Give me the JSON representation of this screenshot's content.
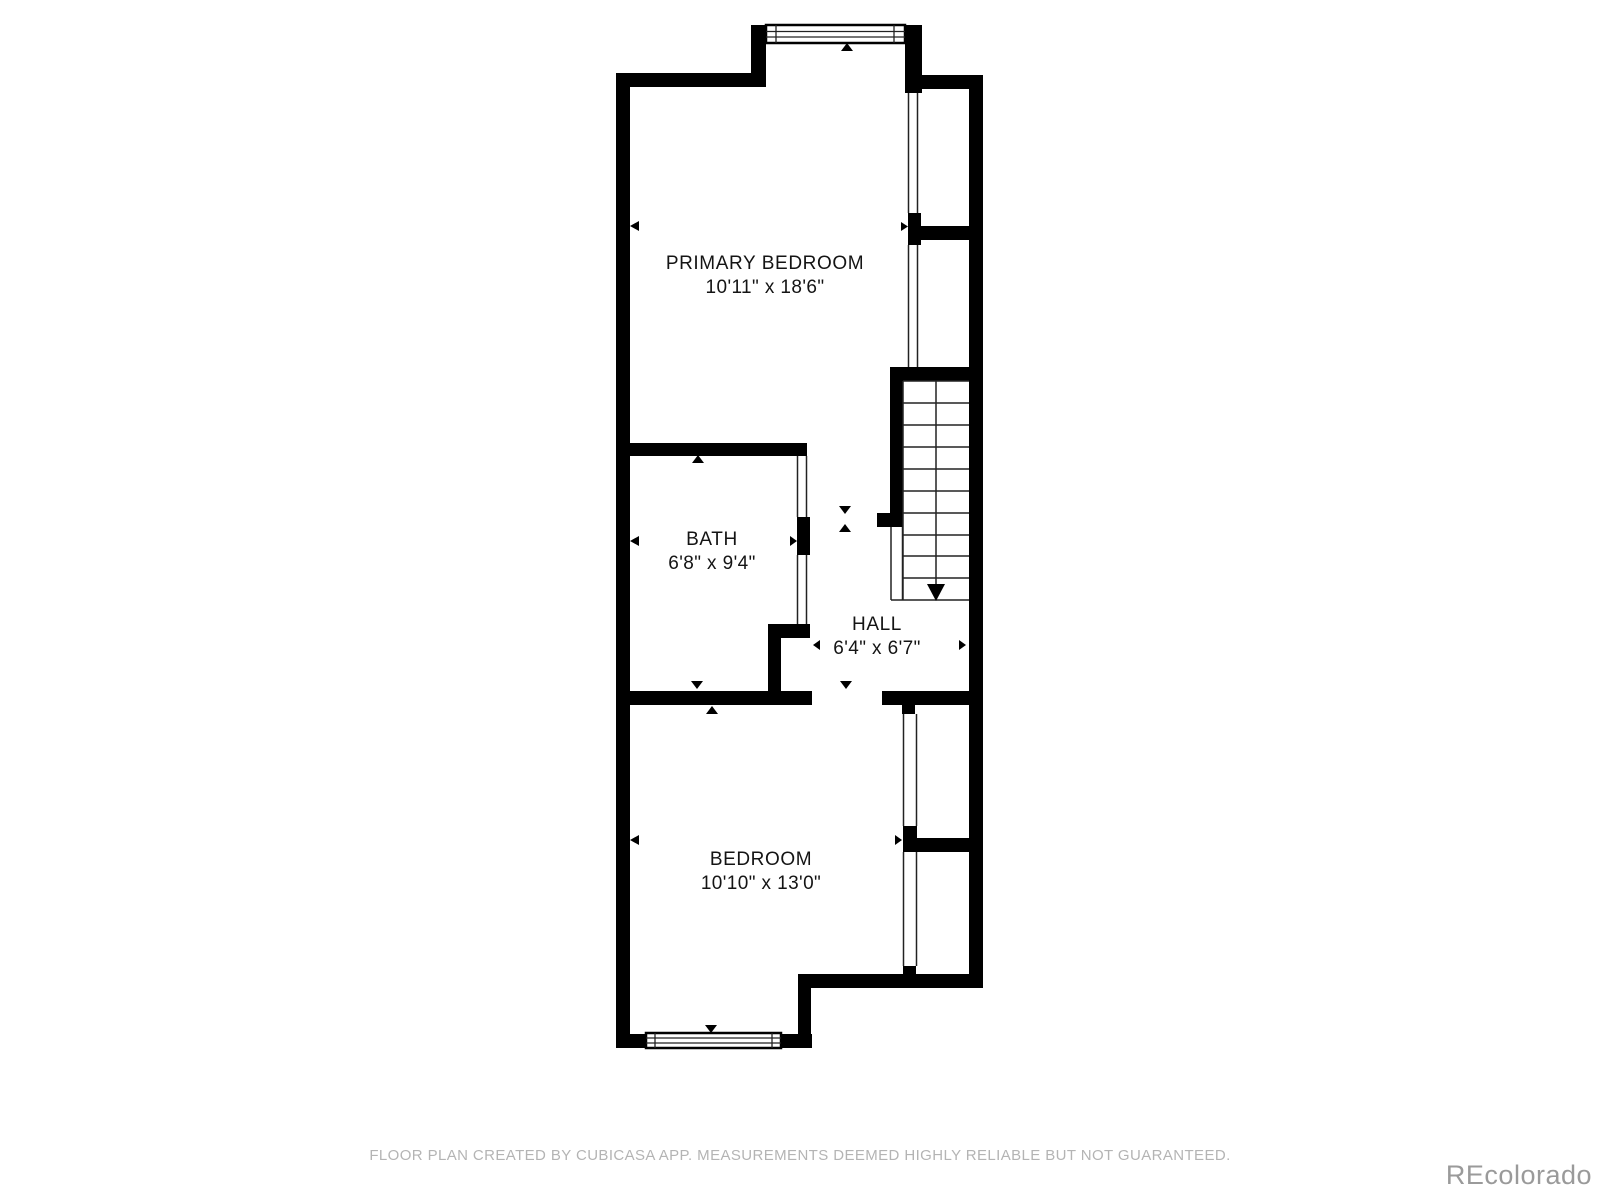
{
  "floor_plan": {
    "rooms": [
      {
        "name": "PRIMARY BEDROOM",
        "dimensions": "10'11\" x 18'6\""
      },
      {
        "name": "BATH",
        "dimensions": "6'8\" x 9'4\""
      },
      {
        "name": "HALL",
        "dimensions": "6'4\" x 6'7\""
      },
      {
        "name": "BEDROOM",
        "dimensions": "10'10\" x 13'0\""
      }
    ],
    "features": {
      "stairs": "staircase-with-down-arrow",
      "top_window": "double-line-window",
      "bottom_window": "double-line-window",
      "markers": "wall-measurement-triangles"
    },
    "colors": {
      "wall": "#000000",
      "room_text": "#141414",
      "disclaimer_text": "#b4b4b4",
      "watermark_text": "#9a9a9a",
      "background": "#ffffff"
    }
  },
  "footer": {
    "disclaimer": "FLOOR PLAN CREATED BY CUBICASA APP. MEASUREMENTS DEEMED HIGHLY RELIABLE BUT NOT GUARANTEED."
  },
  "watermark": {
    "text": "REcolorado"
  }
}
